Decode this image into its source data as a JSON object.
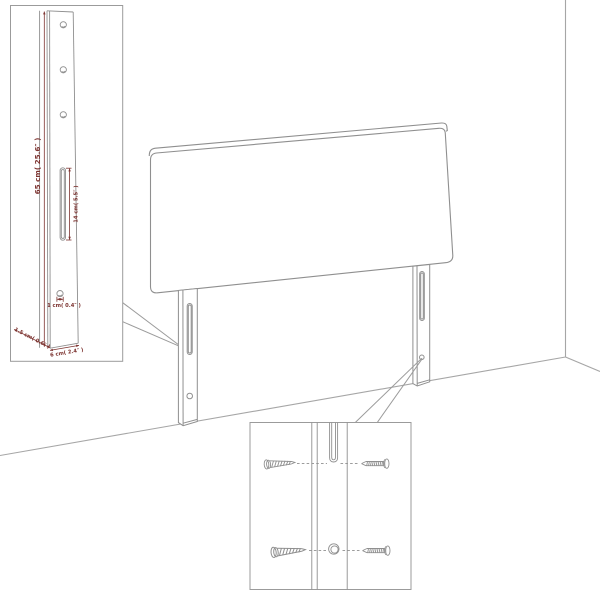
{
  "colors": {
    "line": "#8f8f8f",
    "wall_line": "#a6a6a6",
    "box_border": "#9b9b9b",
    "dimension": "#7d3431",
    "background": "#ffffff"
  },
  "leg_dimension_inset": {
    "labels": {
      "post_height": "65 cm( 25.6″ )",
      "slot_length": "14 cm( 5.5″ )",
      "hole_diameter": "1 cm( 0.4″ )",
      "foot_depth": "1.5 cm( 0.6″ )",
      "foot_width": "6 cm( 2.4″ )"
    }
  }
}
